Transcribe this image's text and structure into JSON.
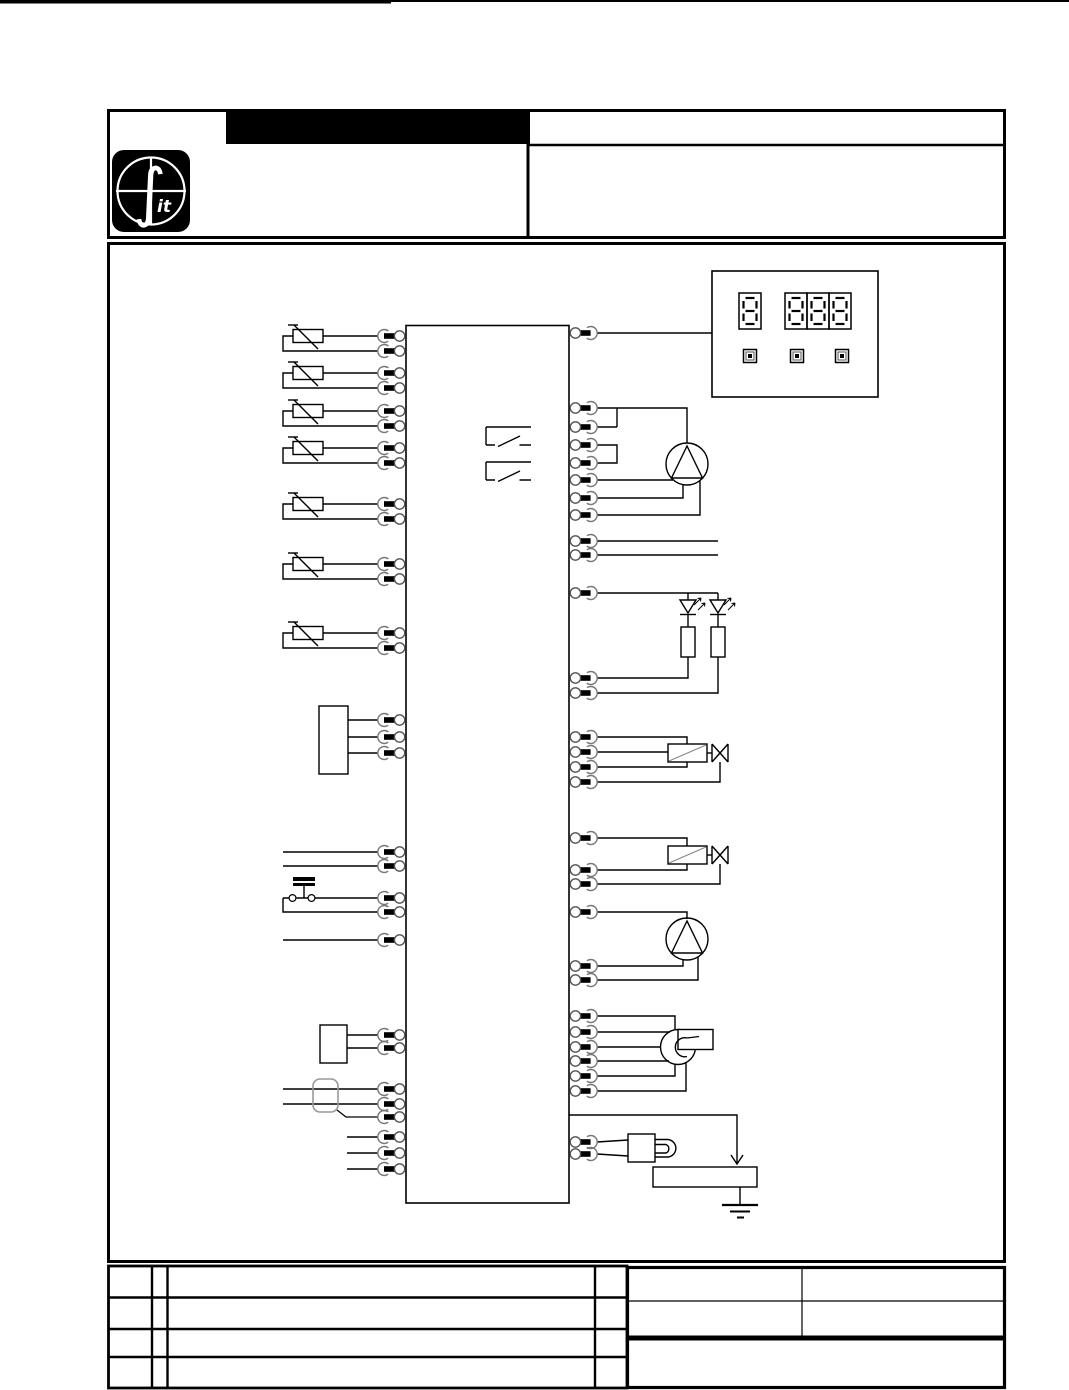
{
  "document": {
    "type": "wiring-diagram-sheet",
    "colors": {
      "paper": "#ffffff",
      "ink": "#000000",
      "light_stroke": "#777777",
      "soft_stroke": "#999999",
      "coil_diagonal": "#888888"
    },
    "header": {
      "logo": {
        "glyph": "∫",
        "text": "it"
      },
      "title_bar_fill": "#000000"
    },
    "display_unit": {
      "single_digit_count": 1,
      "grouped_digit_count": 3,
      "digit_pattern": "8",
      "button_count": 3
    },
    "components": {
      "left": [
        {
          "type": "ntc-thermistor",
          "count": 7,
          "wires_each": 2
        },
        {
          "type": "terminal-block",
          "wires": 3
        },
        {
          "type": "plain-line-pair",
          "wires": 2
        },
        {
          "type": "pressure-switch",
          "wires": 2
        },
        {
          "type": "plain-line-single",
          "wires": 1
        },
        {
          "type": "terminal-block",
          "wires": 2
        },
        {
          "type": "ferrite-filter",
          "wires": 3
        },
        {
          "type": "plain-line-triple",
          "wires": 3
        }
      ],
      "right": [
        {
          "type": "display-unit",
          "wires": 1
        },
        {
          "type": "pump",
          "wires": 7
        },
        {
          "type": "plain-line-pair",
          "wires": 2
        },
        {
          "type": "led-pair-with-resistors",
          "wires": 3
        },
        {
          "type": "solenoid-valve",
          "wires": 4
        },
        {
          "type": "solenoid-valve",
          "wires": 3
        },
        {
          "type": "pump",
          "wires": 3
        },
        {
          "type": "fan-blower",
          "wires": 6
        },
        {
          "type": "spark-igniter",
          "wires": 2
        },
        {
          "type": "burner-with-earth-ground",
          "wires": 1
        }
      ]
    },
    "layout": {
      "pins_left_y": [
        336,
        351,
        373,
        388,
        411,
        426,
        448,
        463,
        504,
        519,
        564,
        579,
        633,
        648,
        720,
        737,
        753,
        852,
        866,
        898,
        912,
        940,
        1035,
        1048,
        1089,
        1104,
        1117,
        1137,
        1153,
        1169
      ],
      "pins_right_y": [
        333,
        408,
        427,
        445,
        463,
        480,
        498,
        515,
        541,
        555,
        593,
        678,
        693,
        737,
        752,
        767,
        782,
        838,
        870,
        884,
        912,
        966,
        980,
        1016,
        1032,
        1047,
        1061,
        1076,
        1091,
        1142,
        1154
      ],
      "thermistor_y": [
        336,
        373,
        411,
        448,
        504,
        564,
        633
      ],
      "digit_x": [
        739,
        785,
        807,
        829
      ],
      "digit_y": 293,
      "button_x": [
        750,
        797,
        842
      ],
      "button_y": 356
    }
  }
}
